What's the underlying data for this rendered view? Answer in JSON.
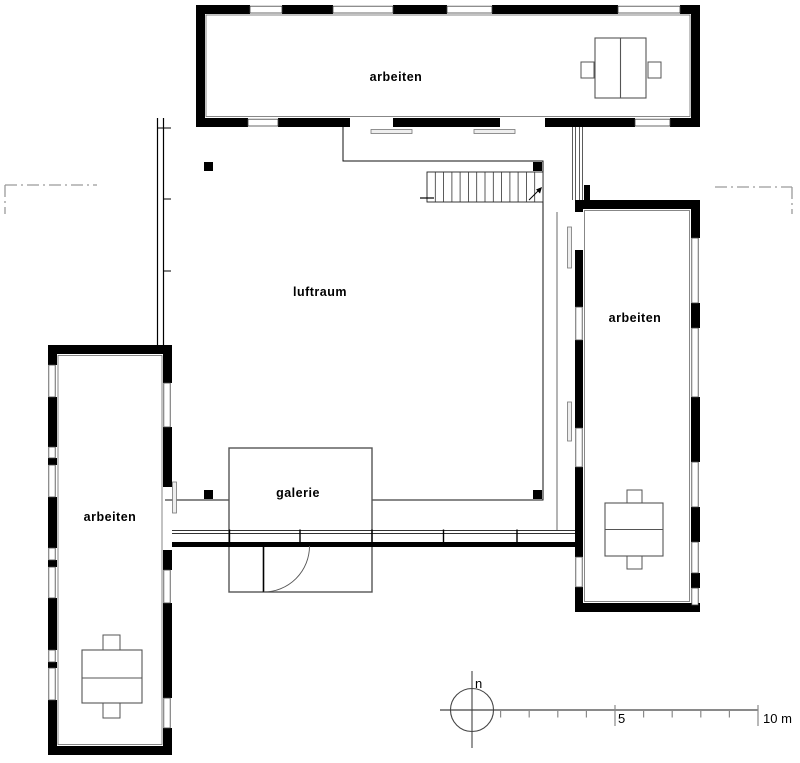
{
  "rooms": [
    {
      "id": "top-wing",
      "label": "arbeiten"
    },
    {
      "id": "right-wing",
      "label": "arbeiten"
    },
    {
      "id": "left-wing",
      "label": "arbeiten"
    },
    {
      "id": "void",
      "label": "luftraum"
    },
    {
      "id": "gallery",
      "label": "galerie"
    }
  ],
  "compass": {
    "label": "n"
  },
  "scale_bar": {
    "mid_tick_label": "5",
    "end_label": "10 m"
  },
  "colors": {
    "background": "#ffffff",
    "wall": "#000000",
    "thin_line": "#444444",
    "medium_line": "#555555",
    "section_line": "#9a9a9a",
    "scale_line": "#8a8a8a",
    "text": "#000000"
  }
}
